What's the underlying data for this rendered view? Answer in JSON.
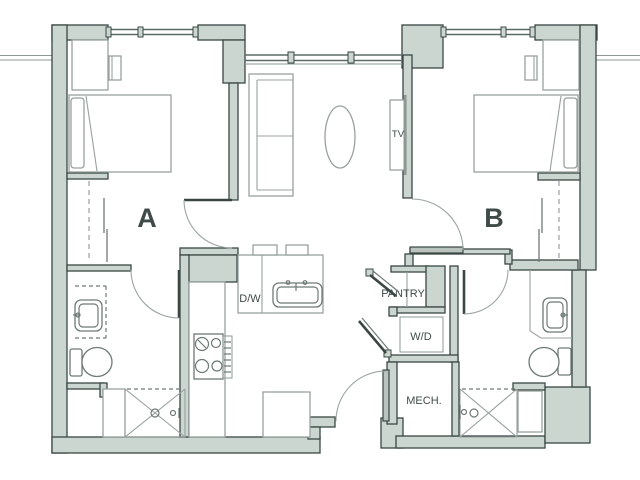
{
  "plan": {
    "bedroom_a_label": "A",
    "bedroom_b_label": "B",
    "tv_label": "TV",
    "dishwasher_label": "D/W",
    "pantry_label": "PANTRY",
    "washer_dryer_label": "W/D",
    "mech_label": "MECH."
  },
  "colors": {
    "wall_fill": "#ccd6d1",
    "wall_line": "#3a4744",
    "furniture_line": "#98a19e",
    "fixture_line": "#6e7a77",
    "label_text": "#3f4b48",
    "background": "#ffffff"
  }
}
